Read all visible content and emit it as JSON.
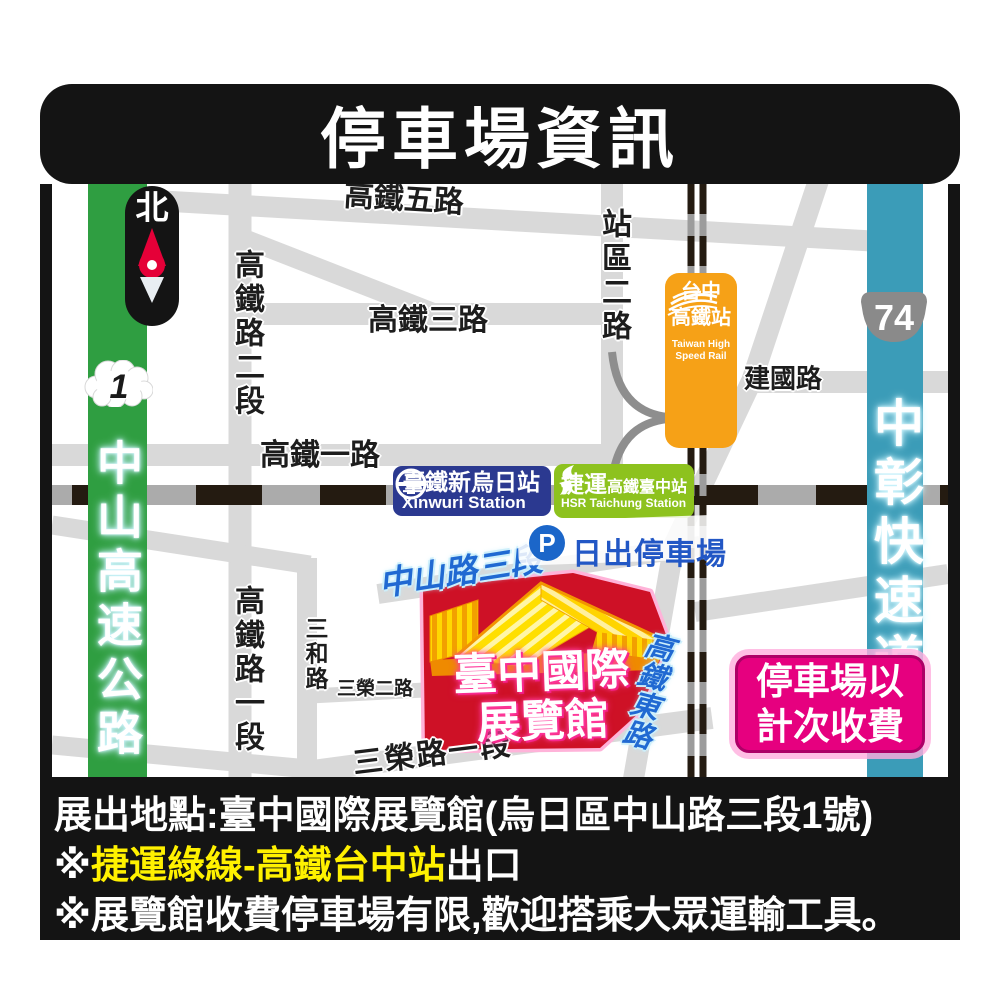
{
  "title": "停車場資訊",
  "compass": {
    "north": "北"
  },
  "shields": {
    "national_highway_1": "1",
    "expressway_74": "74"
  },
  "roads": {
    "zhongshan_freeway": "中山高速公路",
    "zhongchang_expressway": "中彰快速道路",
    "hsr_5th_rd": "高鐵五路",
    "hsr_3rd_rd": "高鐵三路",
    "hsr_1st_rd": "高鐵一路",
    "hsr_rd_sec2": "高鐵路二段",
    "hsr_rd_sec1": "高鐵路一段",
    "station_area_2nd_rd": "站區二路",
    "jianguo_rd": "建國路",
    "sanhe_rd": "三和路",
    "sanrong_2nd_rd": "三榮二路",
    "sanrong_rd_sec1": "三榮路一段",
    "zhongshan_rd_sec3": "中山路三段",
    "hsr_east_rd": "高鐵東路"
  },
  "stations": {
    "hsr": {
      "zh1": "台中",
      "zh2": "高鐵站",
      "en1": "Taiwan High",
      "en2": "Speed Rail"
    },
    "tra": {
      "zh": "臺鐵新烏日站",
      "en": "Xinwuri Station"
    },
    "metro": {
      "zh_prefix": "捷運",
      "zh_suffix": "高鐵臺中站",
      "en": "HSR Taichung Station"
    }
  },
  "parking": {
    "p": "P",
    "name": "日出停車場"
  },
  "venue": {
    "line1": "臺中國際",
    "line2": "展覽館"
  },
  "fee_notice": {
    "line1": "停車場以",
    "line2": "計次收費"
  },
  "footer": {
    "line1": "展出地點:臺中國際展覽館(烏日區中山路三段1號)",
    "line2_prefix": "※",
    "line2_highlight": "捷運綠線-高鐵台中站",
    "line2_suffix": "出口",
    "line3": "※展覽館收費停車場有限,歡迎搭乘大眾運輸工具。"
  },
  "colors": {
    "freeway_green": "#2f9e41",
    "expressway_teal": "#3b9cb8",
    "hsr_orange": "#f6a117",
    "tra_blue": "#2b3990",
    "metro_green": "#8dc21e",
    "parking_blue": "#1b66c9",
    "venue_red": "#ce1126",
    "fee_magenta": "#e6007f",
    "highlight_yellow": "#fff100"
  }
}
